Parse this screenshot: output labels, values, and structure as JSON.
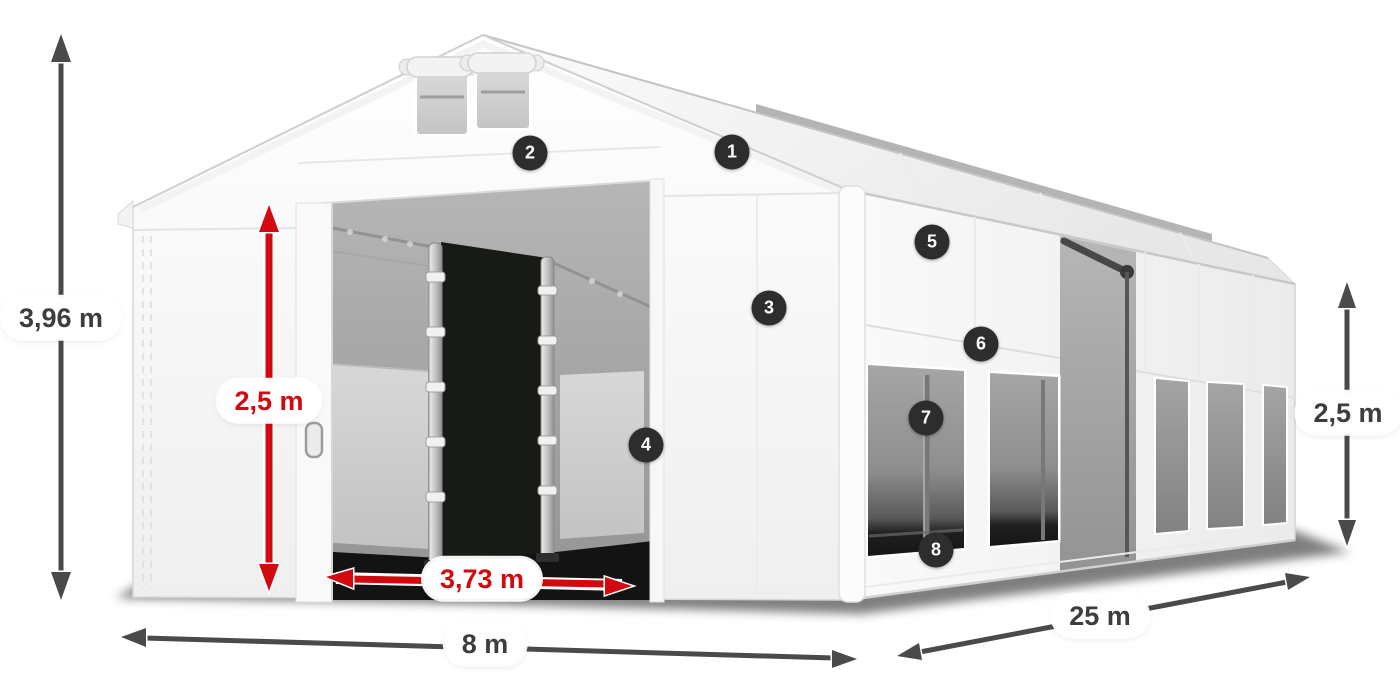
{
  "diagram": {
    "colors": {
      "accent_red": "#d2090f",
      "arrow_gray": "#4a4a4a",
      "badge_background": "#2d2d2d",
      "badge_text": "#ffffff",
      "label_text": "#3d3d3d",
      "label_background": "#ffffff"
    },
    "measurements": {
      "total_height": "3,96 m",
      "entrance_height": "2,5 m",
      "entrance_width": "3,73 m",
      "tent_width": "8 m",
      "tent_length": "25 m",
      "side_wall_height": "2,5 m"
    },
    "badges": [
      "1",
      "2",
      "3",
      "4",
      "5",
      "6",
      "7",
      "8"
    ]
  }
}
